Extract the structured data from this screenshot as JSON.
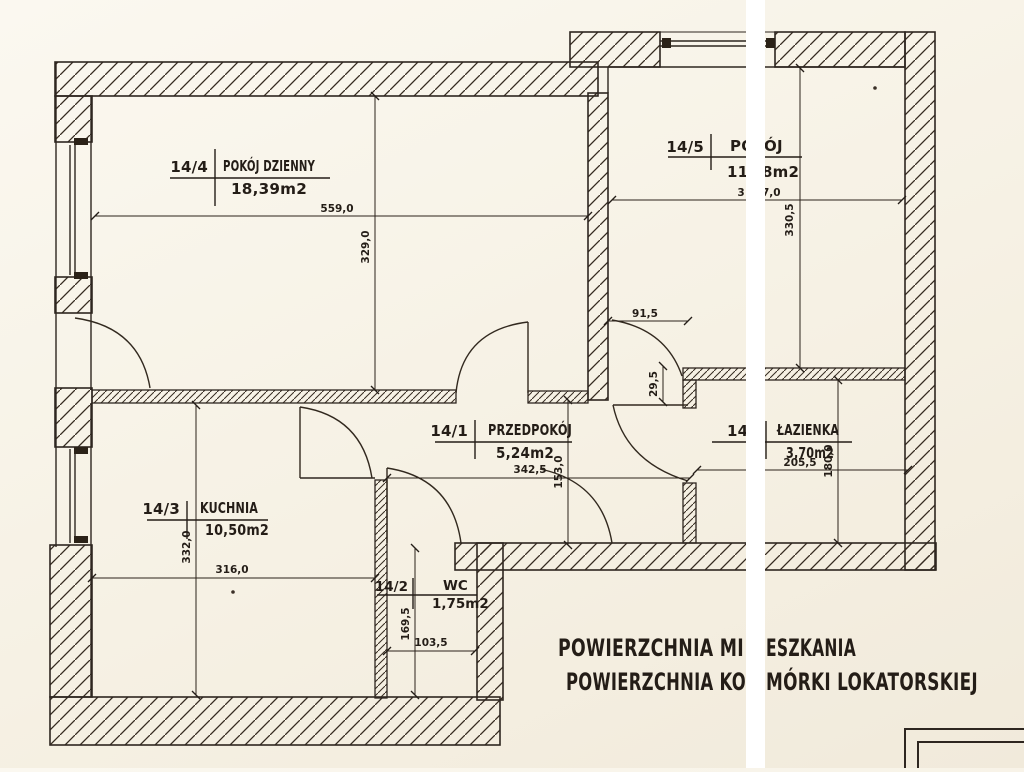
{
  "rooms": {
    "living": {
      "number": "14/4",
      "name": "POKÓJ DZIENNY",
      "area": "18,39m2"
    },
    "room2": {
      "number": "14/5",
      "name_left": "PO",
      "name_right": "ÓJ",
      "area_left": "11,",
      "area_right": "8m2"
    },
    "hall": {
      "number": "14/1",
      "name": "PRZEDPOKÓJ",
      "area": "5,24m2"
    },
    "kitchen": {
      "number": "14/3",
      "name": "KUCHNIA",
      "area": "10,50m2"
    },
    "wc": {
      "number": "14/2",
      "name": "WC",
      "area": "1,75m2"
    },
    "bathroom": {
      "number": "14/",
      "name": "ŁAZIENKA",
      "area": "3,70m2"
    }
  },
  "dimensions": {
    "living_width": "559,0",
    "living_depth": "329,0",
    "room2_width_left": "3",
    "room2_width_right": "7,0",
    "room2_depth": "330,5",
    "room2_door": "91,5",
    "wall_offset": "29,5",
    "hall_width": "342,5",
    "hall_depth": "153,0",
    "bath_width": "205,5",
    "bath_depth": "180,0",
    "kitchen_width": "316,0",
    "kitchen_depth": "332,0",
    "wc_width": "103,5",
    "wc_depth": "169,5"
  },
  "footer": {
    "line1_left": "POWIERZCHNIA MI",
    "line1_right": "ESZKANIA",
    "line2_left": "POWIERZCHNIA KO",
    "line2_right": "MÓRKI LOKATORSKIEJ"
  },
  "colors": {
    "ink": "#2e2620",
    "paper": "#f6f1e4",
    "scan_gap": "#ffffff"
  }
}
